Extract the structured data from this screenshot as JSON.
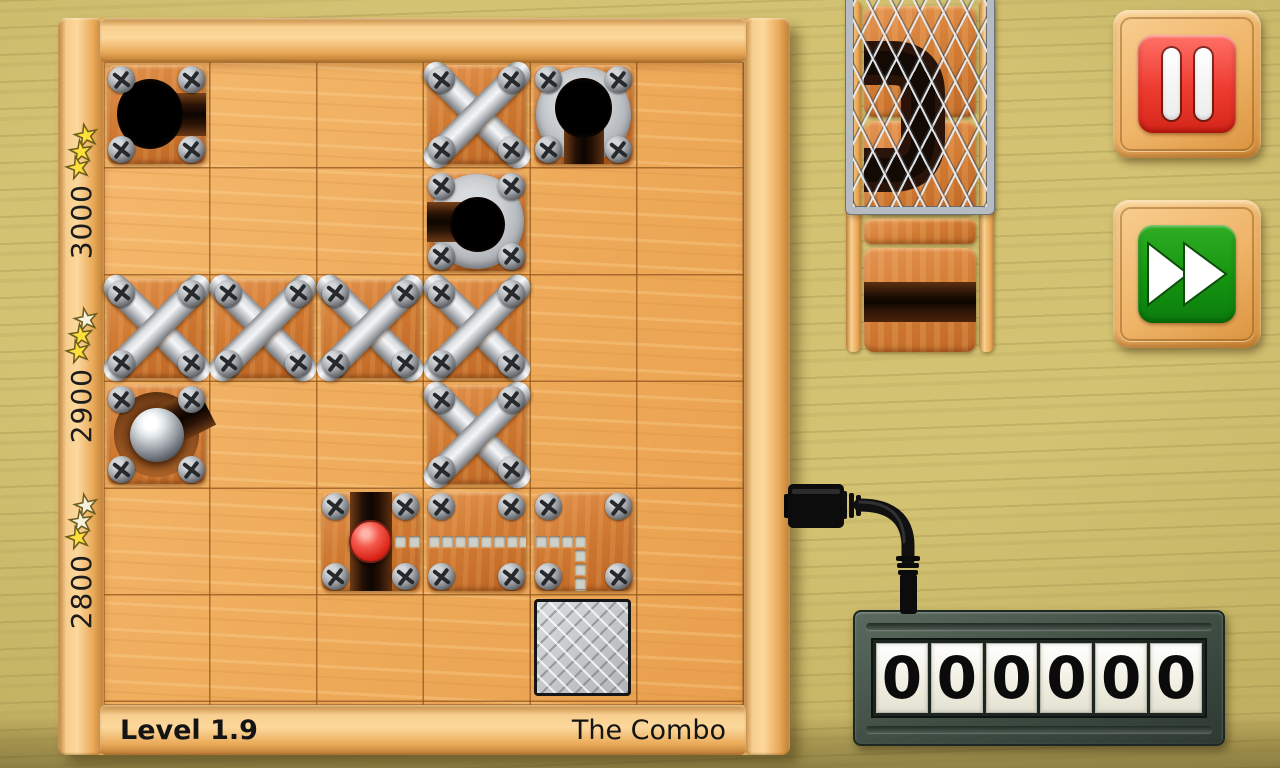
{
  "footer": {
    "level": "Level 1.9",
    "name": "The Combo"
  },
  "score_thresholds": [
    {
      "value": "3000",
      "stars": 3
    },
    {
      "value": "2900",
      "stars": 2
    },
    {
      "value": "2800",
      "stars": 1
    }
  ],
  "board": {
    "rows": 6,
    "cols": 6,
    "tiles": [
      {
        "type": "pipe-end-right",
        "row": 0,
        "col": 0
      },
      {
        "type": "cross-brace",
        "row": 0,
        "col": 3
      },
      {
        "type": "funnel-pipe-down",
        "row": 0,
        "col": 4
      },
      {
        "type": "funnel-pipe-left",
        "row": 1,
        "col": 3
      },
      {
        "type": "cross-brace",
        "row": 2,
        "col": 0
      },
      {
        "type": "cross-brace",
        "row": 2,
        "col": 1
      },
      {
        "type": "cross-brace",
        "row": 2,
        "col": 2
      },
      {
        "type": "cross-brace",
        "row": 2,
        "col": 3
      },
      {
        "type": "marble-cup",
        "row": 3,
        "col": 0
      },
      {
        "type": "cross-brace",
        "row": 3,
        "col": 3
      },
      {
        "type": "button-pipe",
        "row": 4,
        "col": 2
      },
      {
        "type": "dotted-path-horizontal",
        "row": 4,
        "col": 3
      },
      {
        "type": "dotted-path-turn-down",
        "row": 4,
        "col": 4
      },
      {
        "type": "metal-plate",
        "row": 5,
        "col": 4
      }
    ]
  },
  "queue": {
    "caged_piece": "u-turn-pipe",
    "next_piece": "straight-pipe-horizontal"
  },
  "controls": {
    "pause": "pause",
    "fast_forward": "fast-forward"
  },
  "counter": {
    "value": "000000",
    "digits": 6
  },
  "colors": {
    "pause_red": "#ee3b30",
    "fast_forward_green": "#15940f",
    "counter_frame": "#3e4c42",
    "board_wood": "#eeaa59",
    "star_gold": "#ffdf39"
  }
}
